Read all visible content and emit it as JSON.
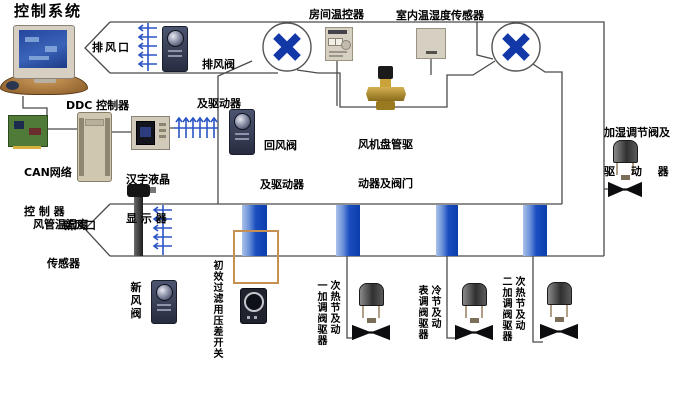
{
  "title": "控制系统",
  "colors": {
    "fan_blue": "#1238a8",
    "damper_blue": "#2b55c4",
    "coil_blue": "#1b4ec0",
    "filter_frame_orange": "#c78f52"
  },
  "icons": {
    "fan_symbol": "crossed-blades",
    "damper_symbol": "comb-arrows",
    "inlet_symbol": "chevron"
  },
  "labels": {
    "title": "控制系统",
    "exhaust_outlet": "排风口",
    "exhaust_damper_l1": "排风阀",
    "exhaust_damper_l2": "及驱动器",
    "room_thermostat": "房间温控器",
    "indoor_sensor": "室内温湿度传感器",
    "ddc_controller": "DDC 控制器",
    "can_l1": "CAN网络",
    "can_l2": "控 制 器",
    "lcd_l1": "汉字液晶",
    "lcd_l2": "显 示 器",
    "return_damper_l1": "回风阀",
    "return_damper_l2": "及驱动器",
    "fan_coil_l1": "风机盘管驱",
    "fan_coil_l2": "动器及阀门",
    "duct_sensor_l1": "风管温湿度",
    "duct_sensor_l2": "传感器",
    "fresh_outlet": "新风口",
    "fresh_valve_v": "新风阀",
    "filter_switch_v": "初效过滤用压差开关",
    "humid_l1": "加湿调节阀及",
    "humid_l2": "驱 动 器",
    "primary_heat_c1": "一加调阀驱器",
    "primary_heat_c2": "次热节及动",
    "cooling_c1": "表调阀驱器",
    "cooling_c2": "冷节及动",
    "secondary_heat_c1": "二加调阀驱器",
    "secondary_heat_c2": "次热节及动"
  }
}
